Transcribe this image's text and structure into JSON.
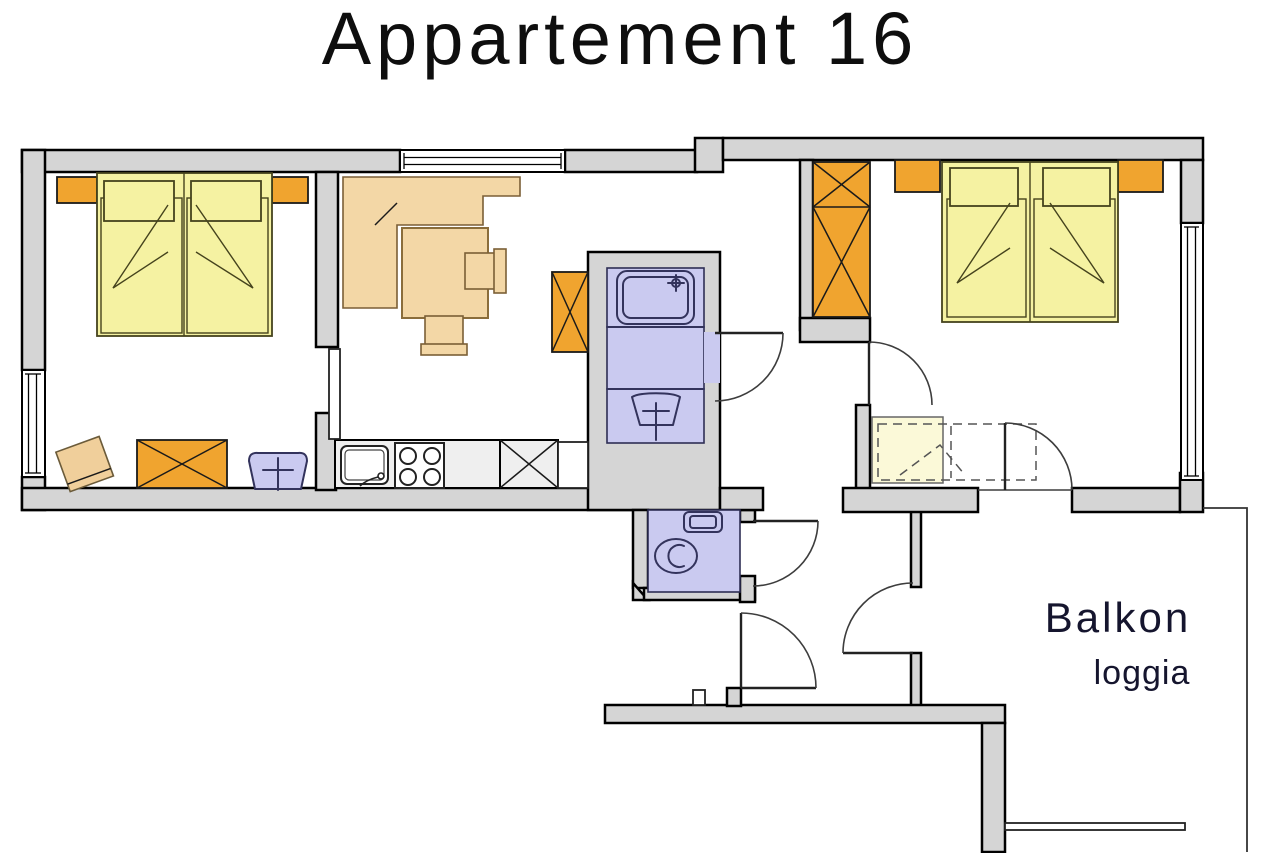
{
  "title": "Appartement 16",
  "balcony": {
    "label": "Balkon",
    "sublabel": "loggia"
  },
  "colors": {
    "wall": "#d5d5d5",
    "counter": "#efefef",
    "bed": "#f5f2a2",
    "bedpale": "#fbf9d8",
    "orange": "#f0a42f",
    "tan": "#f3d7a6",
    "tanchair": "#f0cf9b",
    "purple": "#cacaf0",
    "navy": "#33335c",
    "ink": "#0e0e0e",
    "balkon": "#15152e"
  },
  "icons": {
    "double-bed-icon": "yellow-rect-pillows-fold",
    "nightstand-icon": "orange-rect",
    "wardrobe-icon": "orange-rect-x",
    "cabinet-icon": "rect-x",
    "corner-bench-icon": "tan-L-polygon",
    "table-icon": "tan-rect",
    "chair-icon": "tan-square-back",
    "sink-icon": "rounded-square-tap",
    "stove-icon": "square-4-burners",
    "shower-icon": "rounded-square-showerhead",
    "washbasin-icon": "trapezoid-cross-tap",
    "toilet-icon": "ellipse-bowl",
    "cistern-icon": "rounded-rect",
    "folding-bed-icon": "dashed-rect",
    "door-icon": "quarter-arc-leaf",
    "window-icon": "double-line-strip",
    "railing-icon": "thin-double-line"
  }
}
